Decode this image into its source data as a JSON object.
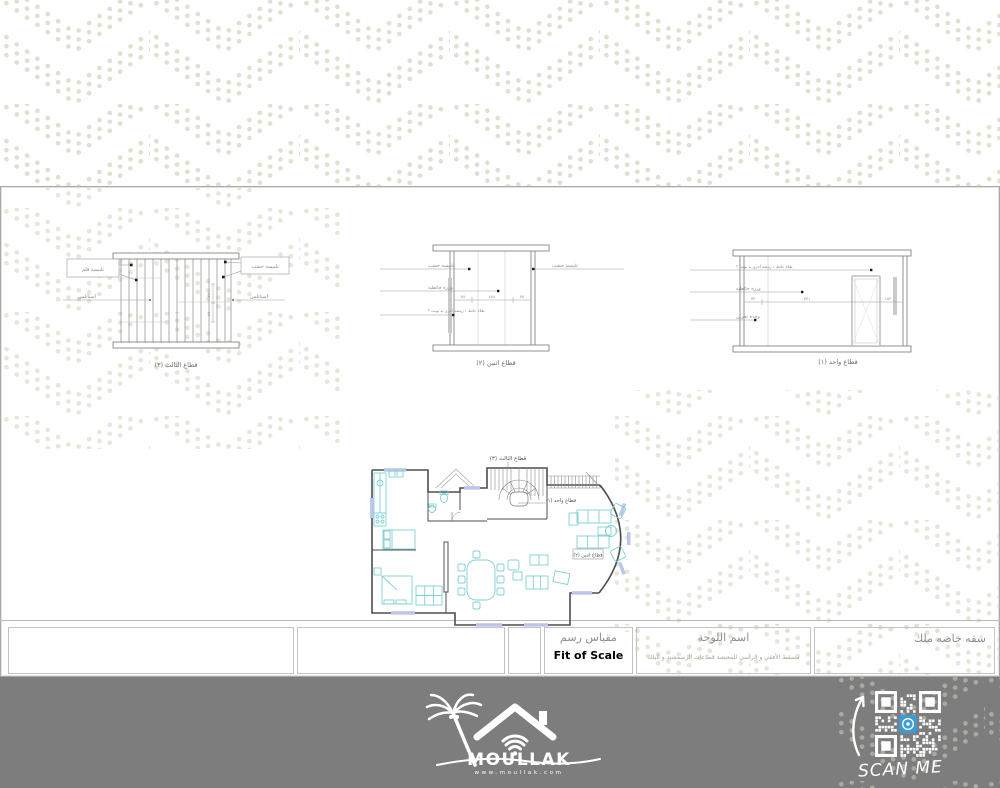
{
  "colors": {
    "pattern_dot": "#dce2cf",
    "footer_bg": "#7d7d7d",
    "furniture": "#7fd0d4",
    "window_fill": "#bcc6e6",
    "qr_icon_blue": "#3d9bd4"
  },
  "sections": {
    "s3": {
      "caption": "قطاع الثالث (٣)",
      "label_left_box": "تلبيسة قلم",
      "label_left_2": "استانلس",
      "label_right_box": "تلبيسة خشب",
      "label_right_2": "استانلس",
      "dim_a": "٢٨",
      "dim_b": "٤٨"
    },
    "s2": {
      "caption": "قطاع اثنين (٢)",
      "label_1": "تلبيسة خشب",
      "label_2": "وزرة حائطية",
      "label_3": "طلاء حائط ١ ريتشه أخرى بد بونت ؟",
      "label_right": "تلبيسة خشب",
      "dim_left": "٧٨",
      "dim_mid": "٤٨٤",
      "dim_right": "٧٨"
    },
    "s1": {
      "caption": "قطاع واحد (١)",
      "label_1": "طلاء حائط ١ ريتشه أخرى بد بونت ؟",
      "label_2": "وزرة حائطية",
      "label_3": "وحدة تخزين",
      "dim_left": "٧٣",
      "dim_mid": "٧٧١",
      "dim_right": "١٥٣"
    }
  },
  "floor_plan": {
    "label_top": "قطاع الثالث (٣)",
    "label_stairs": "قطاع واحد (١)",
    "label_right": "قطاع اثنين (٢)"
  },
  "title_block": {
    "scale_label": "مقياس رسم",
    "scale_value": "Fit of Scale",
    "sheet_label": "اسم اللوحة",
    "sheet_sub": "مسقط الأفقي و الرأسي للمعيشة قطاعات الرسمشيد و البلك",
    "owner": "شقه خاصه ملك"
  },
  "footer": {
    "brand": "MOULLAK",
    "website": "www.moullak.com",
    "scan_me": "SCAN ME"
  }
}
